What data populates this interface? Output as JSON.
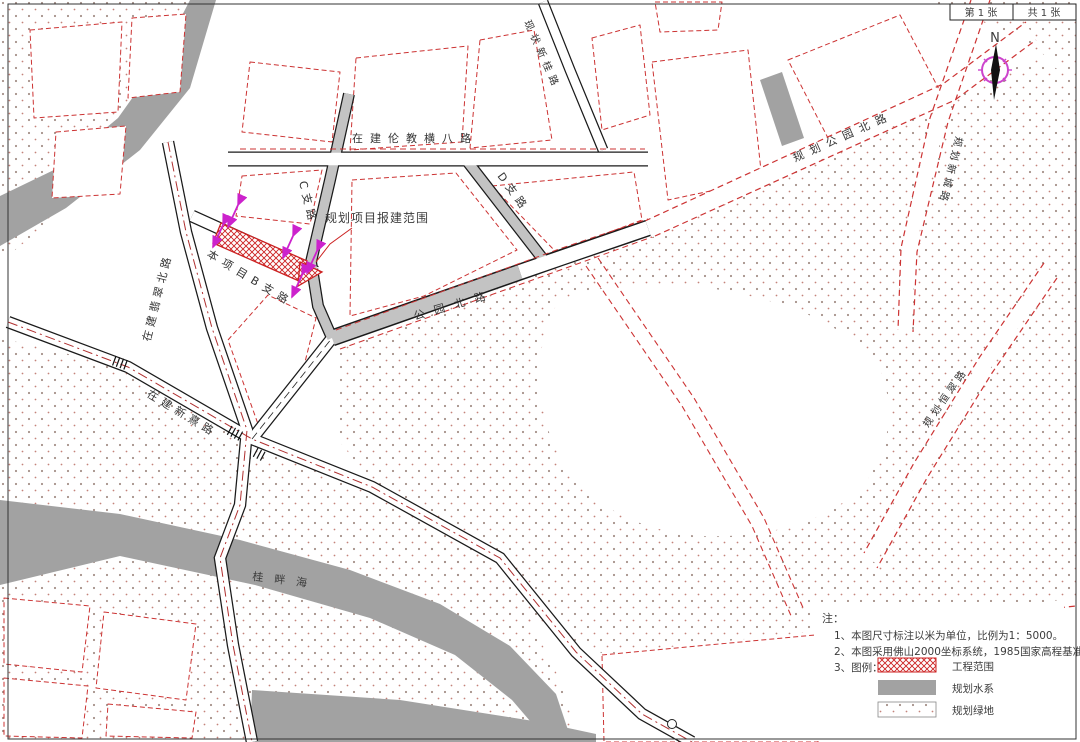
{
  "sheet": {
    "current": "第 1 张",
    "total": "共 1 张"
  },
  "north_label": "N",
  "labels": {
    "road_hengba": "在建伦教横八路",
    "road_c": "C支路",
    "road_d": "D支路",
    "road_b": "本项目B支路",
    "road_gongyuan": "公园北路",
    "road_gongyuan_planned": "规划公园北路",
    "road_feicui": "在建翡翠北路",
    "road_xinxi": "在建新熹路",
    "road_xingui": "现状新桂路",
    "road_xincheng": "规划新城路",
    "road_hengcui": "规划恒翠路",
    "river": "桂畔海",
    "project_label": "规划项目报建范围"
  },
  "notes": {
    "title": "注：",
    "line1": "1、本图尺寸标注以米为单位，比例为1：5000。",
    "line2": "2、本图采用佛山2000坐标系统，1985国家高程基准。",
    "line3_prefix": "3、图例：",
    "legend": [
      {
        "label": "工程范围",
        "type": "red-crosshatch"
      },
      {
        "label": "规划水系",
        "type": "gray-fill"
      },
      {
        "label": "规划绿地",
        "type": "dotted-fill"
      }
    ]
  },
  "colors": {
    "planning_red": "#cc3333",
    "magenta": "#cc22cc",
    "water_gray": "#a2a2a2",
    "road_gray": "#c3c3c3",
    "stipple": "#a59089"
  }
}
